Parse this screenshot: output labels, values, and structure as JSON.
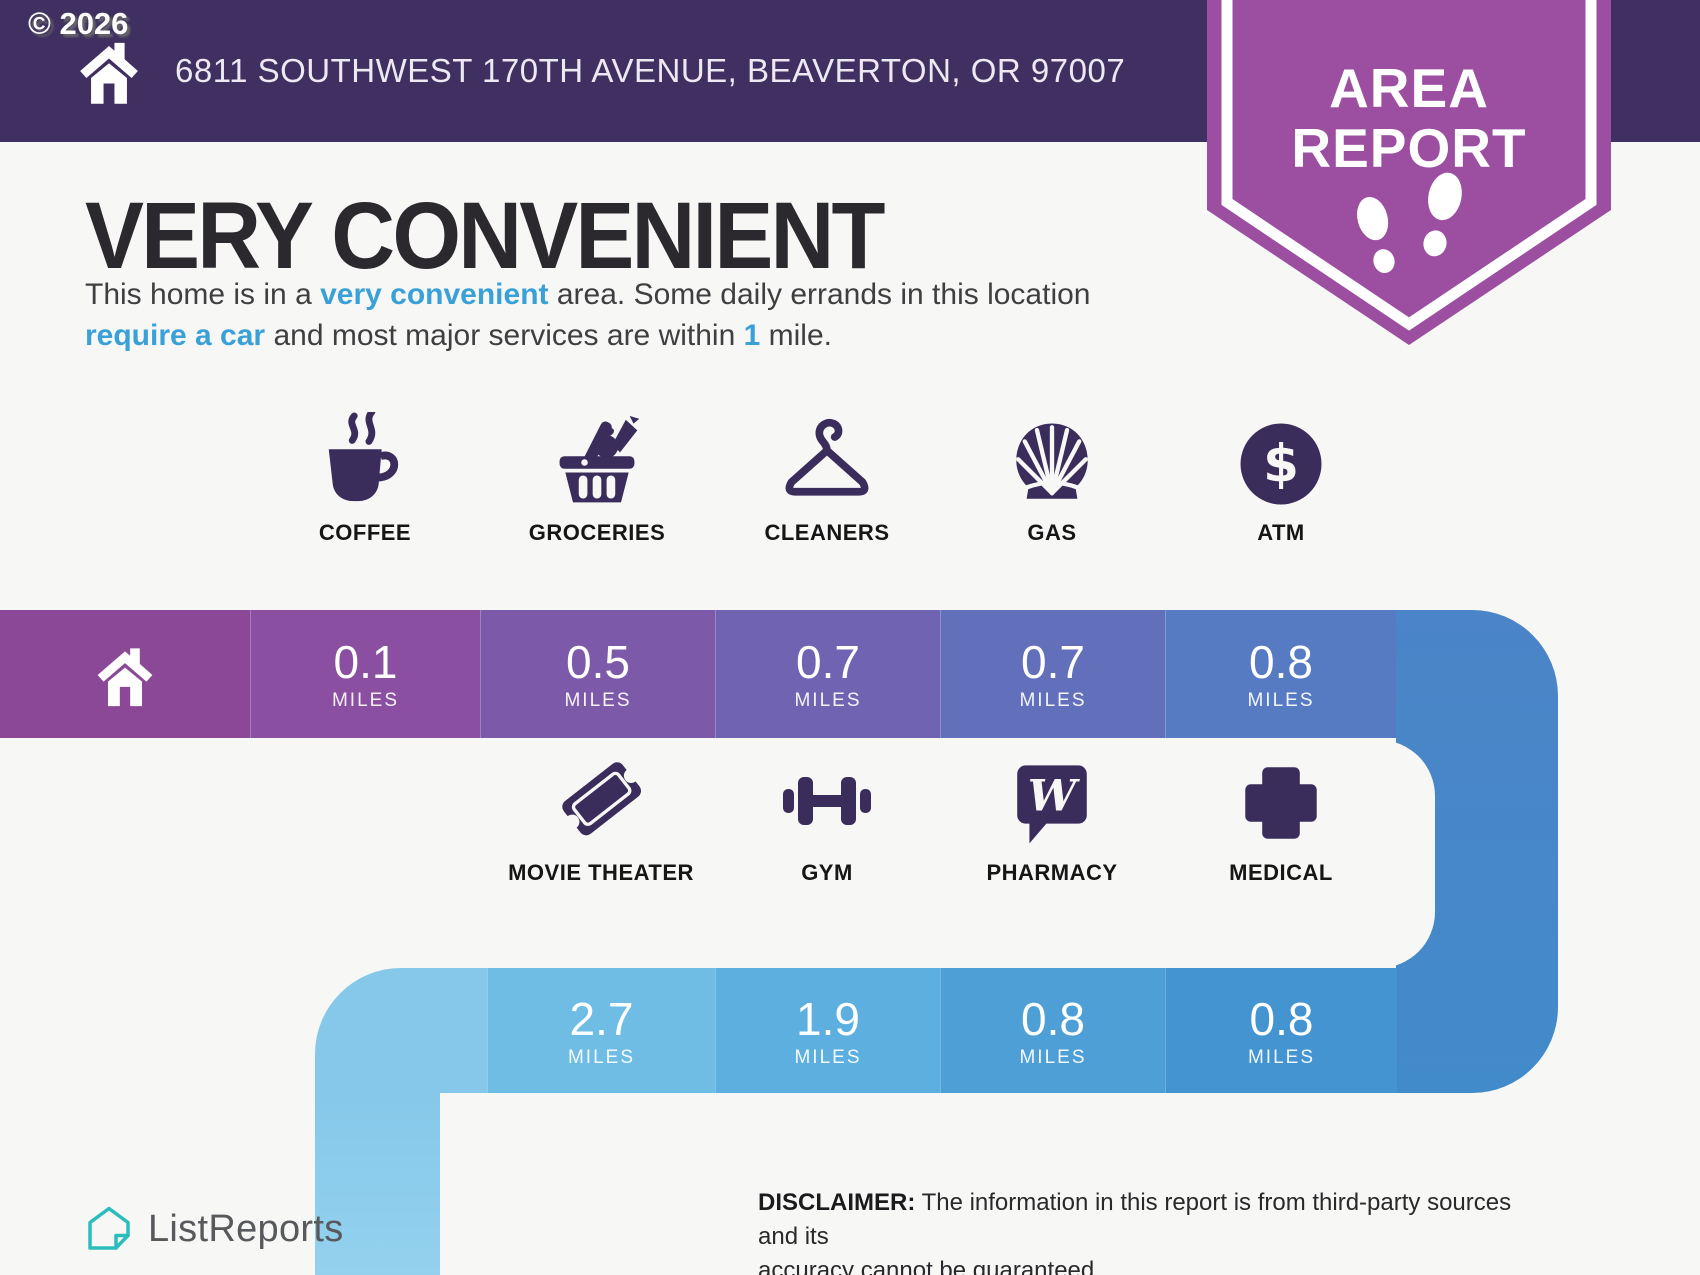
{
  "watermark": "© 2026",
  "header": {
    "address": "6811 SOUTHWEST 170TH AVENUE, BEAVERTON, OR 97007",
    "badge_line1": "AREA",
    "badge_line2": "REPORT"
  },
  "intro": {
    "title": "VERY CONVENIENT",
    "part1": "This home is in a ",
    "highlight1": "very convenient",
    "part2": " area. Some daily errands in this location ",
    "highlight2": "require a car",
    "part3": " and most major services are within ",
    "highlight3": "1",
    "part4": " mile."
  },
  "row1": {
    "items": [
      {
        "label": "COFFEE",
        "icon": "coffee-icon",
        "value": "0.1",
        "unit": "MILES"
      },
      {
        "label": "GROCERIES",
        "icon": "groceries-icon",
        "value": "0.5",
        "unit": "MILES"
      },
      {
        "label": "CLEANERS",
        "icon": "hanger-icon",
        "value": "0.7",
        "unit": "MILES"
      },
      {
        "label": "GAS",
        "icon": "shell-icon",
        "value": "0.7",
        "unit": "MILES"
      },
      {
        "label": "ATM",
        "icon": "dollar-circle-icon",
        "value": "0.8",
        "unit": "MILES"
      }
    ]
  },
  "row2": {
    "items": [
      {
        "label": "MOVIE THEATER",
        "icon": "ticket-icon",
        "value": "2.7",
        "unit": "MILES"
      },
      {
        "label": "GYM",
        "icon": "dumbbell-icon",
        "value": "1.9",
        "unit": "MILES"
      },
      {
        "label": "PHARMACY",
        "icon": "walgreens-icon",
        "value": "0.8",
        "unit": "MILES"
      },
      {
        "label": "MEDICAL",
        "icon": "medical-cross-icon",
        "value": "0.8",
        "unit": "MILES"
      }
    ]
  },
  "footer": {
    "brand": "ListReports",
    "disclaimer_label": "DISCLAIMER:",
    "disclaimer_line1": " The information in this report is from third-party sources and its",
    "disclaimer_line2": "accuracy cannot be guaranteed."
  },
  "colors": {
    "header_purple": "#3f3061",
    "badge_purple": "#9c4fa0",
    "icon_purple": "#3b2d5b",
    "highlight_blue": "#3aa0d8",
    "background": "#f7f7f6",
    "bar_row1": [
      "#8a4897",
      "#8a4fa0",
      "#7d59a9",
      "#6f63b2",
      "#6270bc",
      "#577bc2"
    ],
    "bar_turn_right": [
      "#4b84c8",
      "#428bca"
    ],
    "bar_row2": [
      "#86c8ea",
      "#6fbde5",
      "#5cafdf",
      "#4d9fd6",
      "#4394d0"
    ],
    "bar_turn_left": [
      "#86c8ea",
      "#93d1ee"
    ],
    "logo_teal": "#2abdbb"
  }
}
